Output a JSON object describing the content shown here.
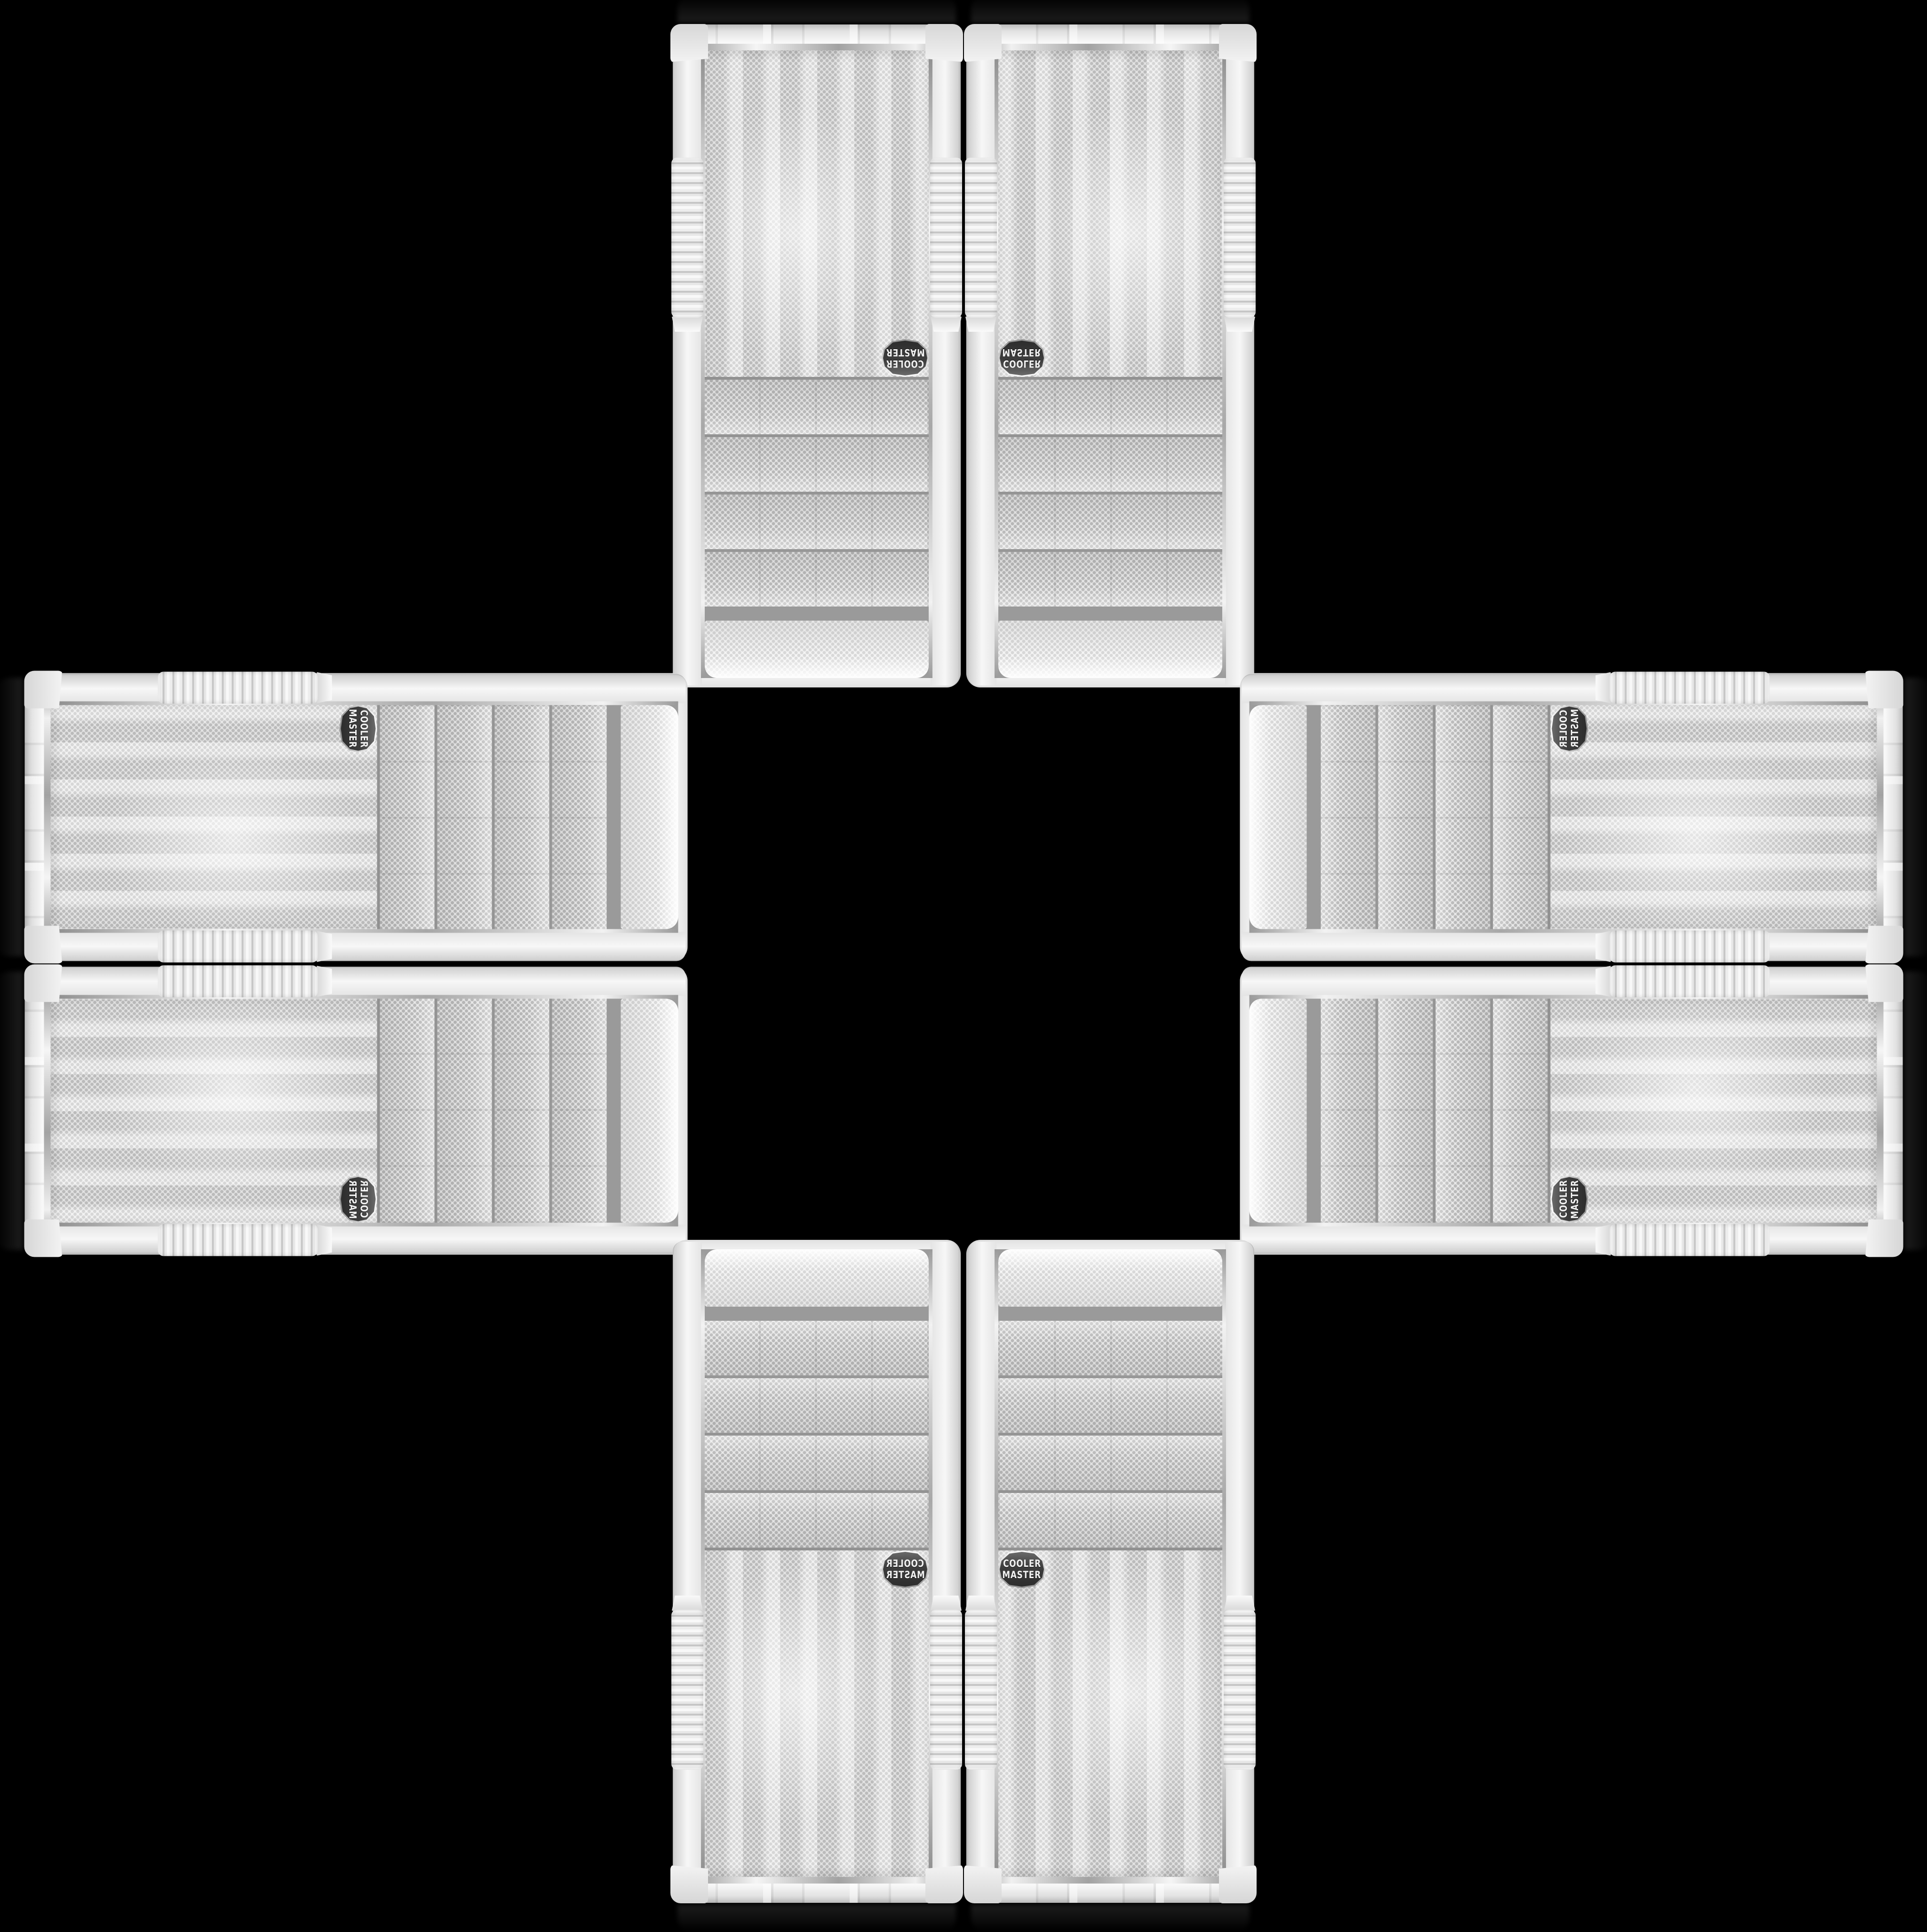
{
  "image": {
    "description": "Eight identical white Cooler Master mini-tower PC cases arranged in a plus / cross kaleidoscope pattern on a black background, mirrored and rotated around an empty center",
    "background_color": "#000000"
  },
  "brand": {
    "line1": "COOLER",
    "line2": "MASTER"
  },
  "badge": {
    "background": "#3e3e3e",
    "rim": "#d2d2d2",
    "text_color": "#f2f2f2"
  },
  "palette": {
    "case_body_highlight": "#f6f6f6",
    "case_body_shadow": "#dcdcdc",
    "mesh_base": "#ececec",
    "mesh_dot": "#c3c3c3",
    "bay_base": "#e7e7e7",
    "bay_dot": "#b9b9b9",
    "curved_vent_base": "#f5f5f5",
    "curved_vent_dot": "#d9d9d9",
    "chrome_mid": "#a2a2a2"
  },
  "cases": [
    {
      "id": "top-left",
      "orientation": "rotated-180"
    },
    {
      "id": "top-right",
      "orientation": "flipped-vertical"
    },
    {
      "id": "left-top",
      "orientation": "rotated-90-cw"
    },
    {
      "id": "left-bottom",
      "orientation": "rotated-90-cw-flipped"
    },
    {
      "id": "right-top",
      "orientation": "rotated-90-ccw-flipped"
    },
    {
      "id": "right-bottom",
      "orientation": "rotated-90-ccw"
    },
    {
      "id": "bottom-left",
      "orientation": "flipped-horizontal"
    },
    {
      "id": "bottom-right",
      "orientation": "original"
    }
  ]
}
